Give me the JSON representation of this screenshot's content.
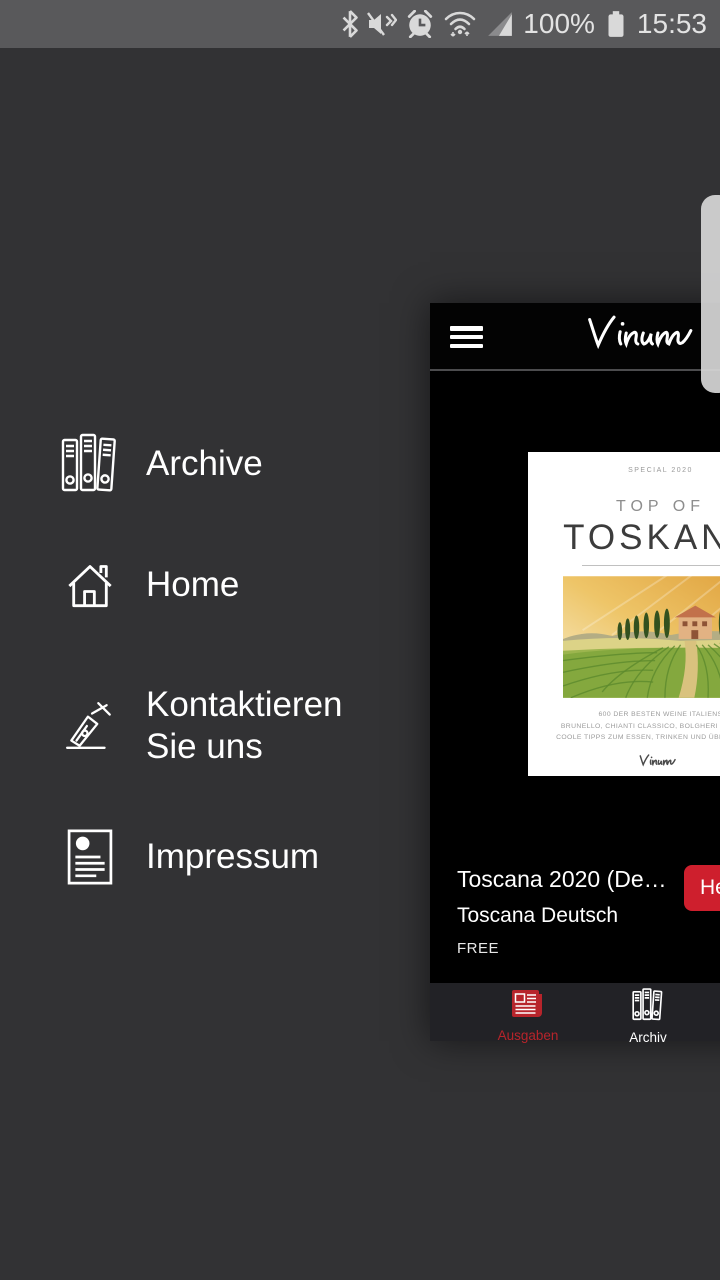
{
  "status_bar": {
    "time": "15:53",
    "battery_percent": "100%"
  },
  "drawer": {
    "items": [
      {
        "label": "Archive"
      },
      {
        "label": "Home"
      },
      {
        "label": "Kontaktieren Sie uns"
      },
      {
        "label": "Impressum"
      }
    ]
  },
  "app": {
    "logo": "Vinum",
    "cover": {
      "tag": "SPECIAL 2020",
      "title_top": "TOP OF",
      "title": "TOSKANA",
      "subline1": "600 DER BESTEN WEINE ITALIENS",
      "subline2": "BRUNELLO, CHIANTI CLASSICO, BOLGHERI UND MEHR",
      "subline3": "COOLE TIPPS ZUM ESSEN, TRINKEN UND ÜBERNACHTEN"
    },
    "issue": {
      "title": "Toscana 2020 (De…",
      "subtitle": "Toscana Deutsch",
      "price": "FREE",
      "action_label": "Herunterladen"
    },
    "tabs": [
      {
        "label": "Ausgaben"
      },
      {
        "label": "Archiv"
      }
    ],
    "colors": {
      "accent_red": "#ce1f2d",
      "tab_red": "#b7242b"
    }
  }
}
